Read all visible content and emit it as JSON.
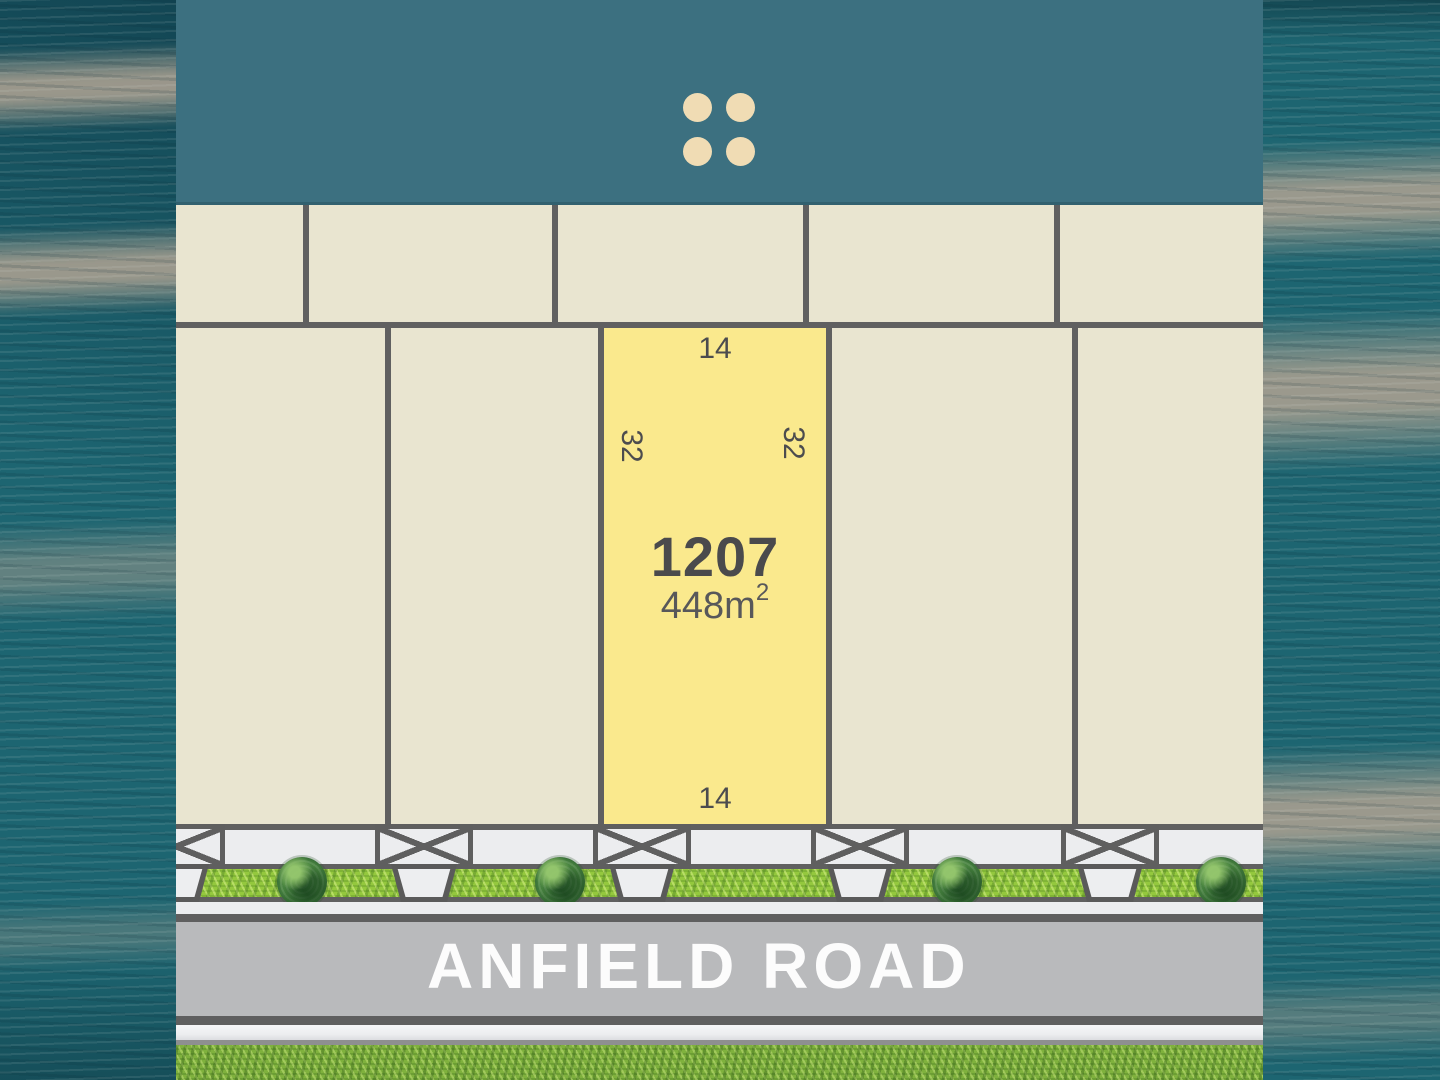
{
  "brand": {
    "logo_icon": "four-dots-grid"
  },
  "plan": {
    "featured_lot": {
      "number": "1207",
      "area_base": "448m",
      "area_exponent": "2",
      "dimensions": {
        "top": "14",
        "bottom": "14",
        "left": "32",
        "right": "32"
      }
    },
    "road": {
      "name": "ANFIELD ROAD"
    }
  },
  "colors": {
    "banner_teal": "#3C7080",
    "lot_beige": "#E9E5D0",
    "featured_yellow": "#FAE98D",
    "boundary_gray": "#606060",
    "path_light": "#ECEDEF",
    "road_gray": "#B9BABC",
    "road_text": "#FCFCFC",
    "verge_green": "#94C83E",
    "lawn_green": "#7FB13D",
    "dots_cream": "#F0DCB4",
    "water_teal": "#1D6571",
    "water_sand": "#A89F90"
  }
}
